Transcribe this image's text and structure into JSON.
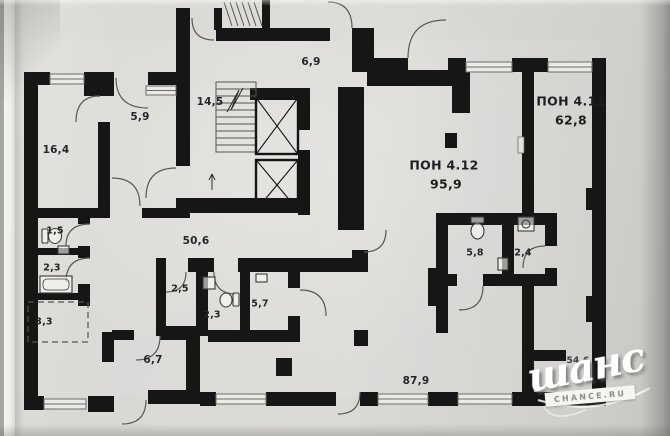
{
  "plan": {
    "premises": {
      "p411": {
        "label": "ПОН 4.11",
        "area": "62,8"
      },
      "p412": {
        "label": "ПОН 4.12",
        "area": "95,9"
      }
    },
    "rooms": {
      "r16_4": {
        "area": "16,4"
      },
      "r5_9": {
        "area": "5,9"
      },
      "r14_5": {
        "area": "14,5"
      },
      "r6_9": {
        "area": "6,9"
      },
      "r50_6": {
        "area": "50,6"
      },
      "r1_5": {
        "area": "1,5"
      },
      "r2_3a": {
        "area": "2,3"
      },
      "r3_3": {
        "area": "3,3"
      },
      "r2_5": {
        "area": "2,5"
      },
      "r2_3b": {
        "area": "2,3"
      },
      "r5_7": {
        "area": "5,7"
      },
      "r6_7": {
        "area": "6,7"
      },
      "r87_9": {
        "area": "87,9"
      },
      "r5_8": {
        "area": "5,8"
      },
      "r2_4": {
        "area": "2,4"
      },
      "r54_6": {
        "area": "54,6"
      }
    },
    "watermark": {
      "brand": "шанс",
      "site": "CHANCE.RU"
    },
    "colors": {
      "wall": "#161616",
      "paper": "#d9d8d4",
      "thin_line": "#4a4a4a"
    }
  }
}
